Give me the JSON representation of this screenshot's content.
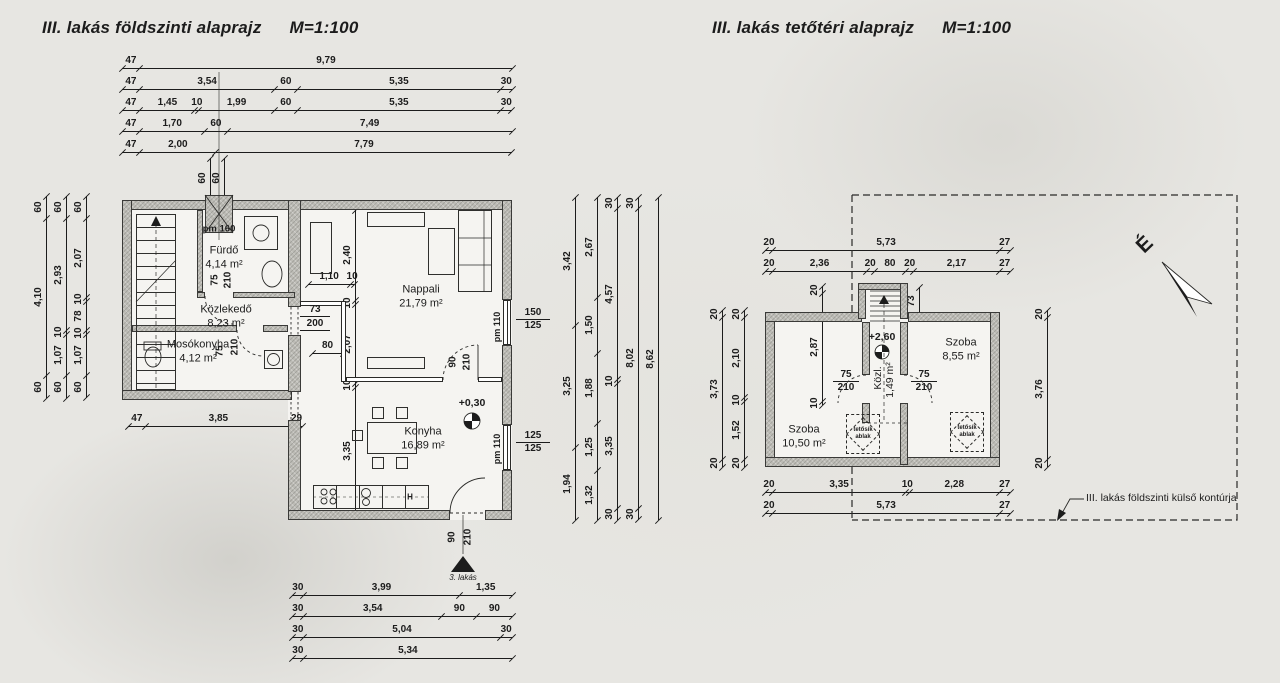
{
  "left_plan": {
    "title": "III. lakás földszinti alaprajz",
    "scale": "M=1:100",
    "top_chains": [
      [
        "47",
        "9,79"
      ],
      [
        "47",
        "3,54",
        "60",
        "5,35",
        "30"
      ],
      [
        "47",
        "1,45",
        "10",
        "1,99",
        "60",
        "5,35",
        "30"
      ],
      [
        "47",
        "1,70",
        "60",
        "7,49"
      ],
      [
        "47",
        "2,00",
        "7,79"
      ]
    ],
    "left_chains": [
      [
        "60",
        "4,10",
        "60"
      ],
      [
        "60",
        "2,93",
        "10",
        "1,07",
        "60"
      ],
      [
        "60",
        "2,07",
        "10",
        "78",
        "10",
        "1,07",
        "60"
      ]
    ],
    "right_chains": [
      [
        "3,42",
        "3,25",
        "1,94"
      ],
      [
        "2,67",
        "1,50",
        "1,88",
        "1,25",
        "1,32"
      ],
      [
        "30",
        "4,57",
        "10",
        "3,35",
        "30"
      ],
      [
        "30",
        "8,02",
        "30"
      ],
      [
        "8,62"
      ]
    ],
    "bottom_chains": [
      [
        "30",
        "3,99",
        "1,35"
      ],
      [
        "30",
        "3,54",
        "90",
        "90"
      ],
      [
        "30",
        "5,04",
        "30"
      ],
      [
        "30",
        "5,34"
      ]
    ],
    "mid_chain": [
      "47",
      "3,85",
      "29"
    ],
    "vent_chains": [
      [
        "60"
      ],
      [
        "60"
      ]
    ],
    "nappali_vchain": [
      "2,40",
      "10",
      "2,07",
      "10",
      "3,35"
    ],
    "sideboard_chain": [
      "1,10",
      "10"
    ],
    "opening80_chain": [
      "80"
    ],
    "rooms": {
      "furdo": {
        "name": "Fürdő",
        "area": "4,14 m²"
      },
      "kozlekedo": {
        "name": "Közlekedő",
        "area": "8,23 m²"
      },
      "mosokonyha": {
        "name": "Mosókonyha",
        "area": "4,12 m²"
      },
      "nappali": {
        "name": "Nappali",
        "area": "21,79 m²"
      },
      "konyha": {
        "name": "Konyha",
        "area": "16,89 m²"
      }
    },
    "labels": {
      "pm160": "pm 160",
      "kozl_op_w": "73",
      "kozl_op_h": "200",
      "furdo_door_w": "75",
      "furdo_door_h": "210",
      "mos_door_w": "75",
      "mos_door_h": "210",
      "nk_door_w": "90",
      "nk_door_h": "210",
      "entry_w": "90",
      "entry_h": "210",
      "entry_note": "3. lakás",
      "level": "+0,30",
      "win1_pm": "pm 110",
      "win1_top": "150",
      "win1_bot": "125",
      "win2_pm": "pm 110",
      "win2_top": "125",
      "win2_bot": "125",
      "fridge": "H"
    }
  },
  "right_plan": {
    "title": "III. lakás tetőtéri alaprajz",
    "scale": "M=1:100",
    "top_chains": [
      [
        "20",
        "5,73",
        "27"
      ],
      [
        "20",
        "2,36",
        "20",
        "80",
        "20",
        "2,17",
        "27"
      ]
    ],
    "bottom_chains": [
      [
        "20",
        "3,35",
        "10",
        "2,28",
        "27"
      ],
      [
        "20",
        "5,73",
        "27"
      ]
    ],
    "left_chains": [
      [
        "20",
        "3,73",
        "20"
      ],
      [
        "20",
        "2,10",
        "10",
        "1,52",
        "20"
      ]
    ],
    "right_chain": [
      "20",
      "3,76",
      "20"
    ],
    "inner_chain": [
      "20",
      "2,87",
      "10"
    ],
    "stair_chain": [
      "73"
    ],
    "rooms": {
      "szoba1": {
        "name": "Szoba",
        "area": "10,50 m²"
      },
      "szoba2": {
        "name": "Szoba",
        "area": "8,55 m²"
      },
      "kozl": {
        "name": "Közl.",
        "area": "1,49 m²"
      }
    },
    "labels": {
      "level": "+2,60",
      "door_l_w": "75",
      "door_l_h": "210",
      "door_r_w": "75",
      "door_r_h": "210",
      "roof_window_1": "tetősík",
      "roof_window_2": "ablak",
      "north": "É",
      "contour": "III. lakás földszinti külső kontúrja"
    }
  }
}
